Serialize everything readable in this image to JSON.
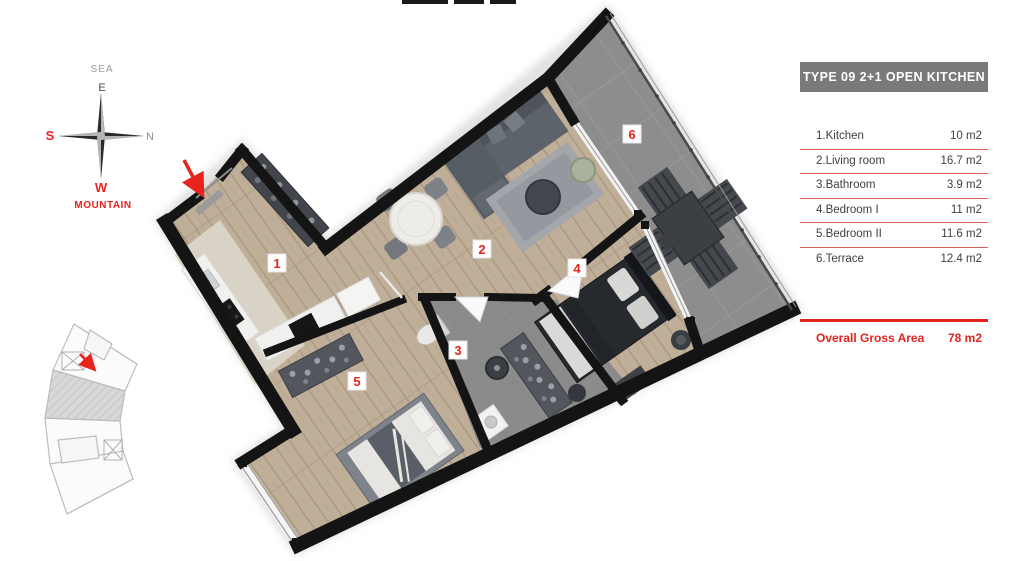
{
  "legend": {
    "header": "TYPE 09  2+1 OPEN KITCHEN",
    "rows": [
      {
        "label": "1.Kitchen",
        "area": "10 m2"
      },
      {
        "label": "2.Living room",
        "area": "16.7 m2"
      },
      {
        "label": "3.Bathroom",
        "area": "3.9 m2"
      },
      {
        "label": "4.Bedroom  I",
        "area": "11 m2"
      },
      {
        "label": "5.Bedroom  II",
        "area": "11.6 m2"
      },
      {
        "label": "6.Terrace",
        "area": "12.4 m2"
      }
    ],
    "total_label": "Overall Gross Area",
    "total_value": "78 m2"
  },
  "compass": {
    "sea": "SEA",
    "east": "E",
    "south": "S",
    "north": "N",
    "west": "W",
    "mountain": "MOUNTAIN"
  },
  "plan": {
    "room_numbers": [
      "1",
      "2",
      "3",
      "4",
      "5",
      "6"
    ]
  },
  "colors": {
    "accent_red": "#e8231e",
    "underline_red": "#d96057",
    "total_red": "#e0241f",
    "header_gray": "#7a7a7a",
    "wall_black": "#141414",
    "wood_floor": "#bfae98",
    "terrace_gray": "#8d8d8d",
    "bathroom_gray": "#898989"
  }
}
